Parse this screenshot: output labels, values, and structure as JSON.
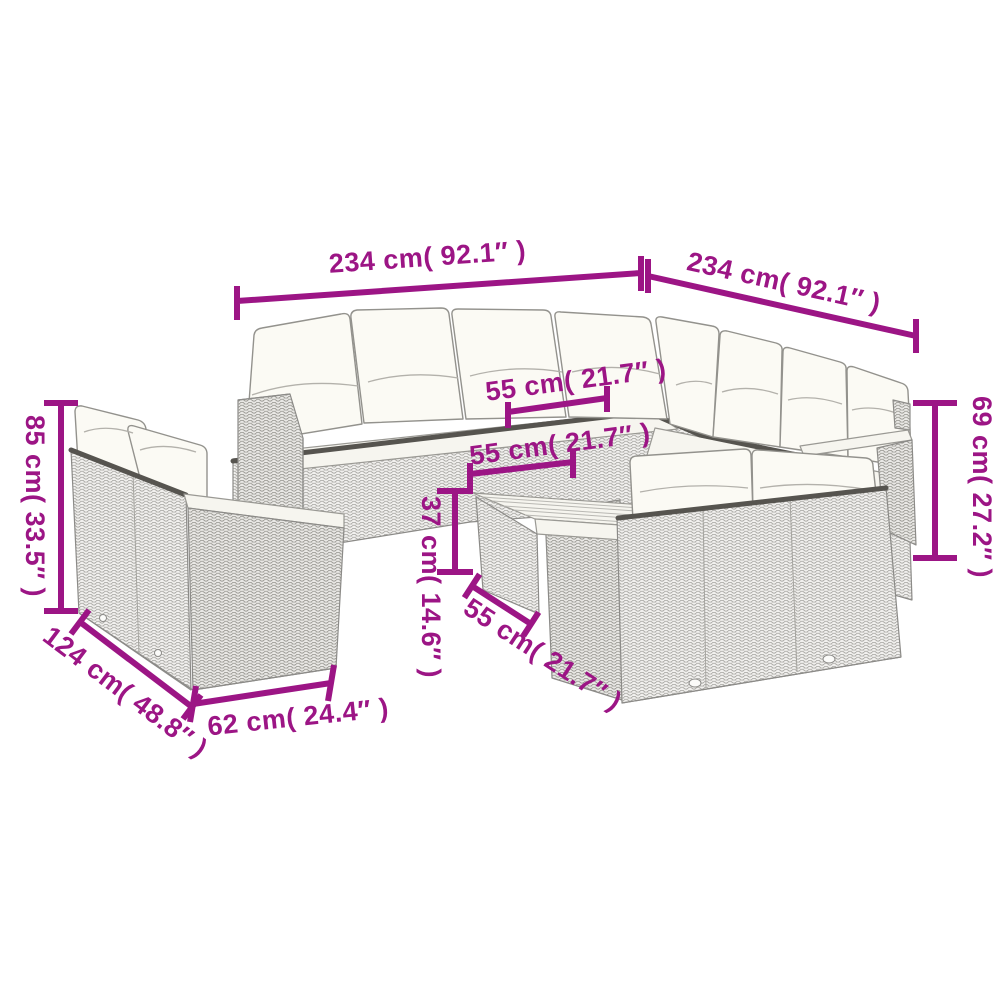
{
  "colors": {
    "dimension": "#9C1585",
    "outline": "#8c8b88",
    "cushion": "#fbfaf4"
  },
  "dimensions": {
    "sofa_left_width": "234 cm( 92.1″ )",
    "sofa_right_width": "234 cm( 92.1″ )",
    "seat_width_back": "55 cm( 21.7″ )",
    "seat_width_front": "55 cm( 21.7″ )",
    "table_height": "37 cm( 14.6″ )",
    "table_width": "55 cm( 21.7″ )",
    "back_height_right": "69 cm( 27.2″ )",
    "back_height_left": "85 cm( 33.5″ )",
    "small_sofa_depth": "124 cm( 48.8″ )",
    "small_sofa_width": "62 cm( 24.4″ )"
  }
}
